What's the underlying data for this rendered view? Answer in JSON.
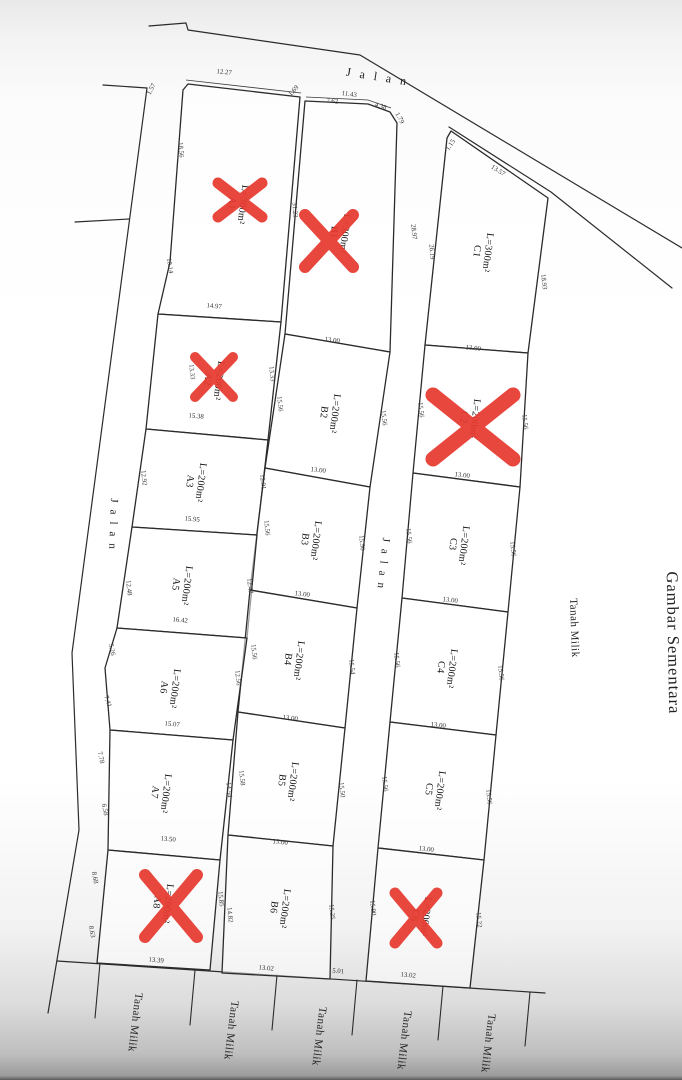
{
  "drawing": {
    "title_note": "Gambar Sementara",
    "road_word": "Jalan",
    "owned_land_word": "Tanah Milik",
    "line_color": "#2b2b2b",
    "cross_color": "#e6392e",
    "dim_color": "#333333"
  },
  "road_labels": [
    {
      "name": "road-label-jalan-top",
      "text": "Jalan",
      "x": 380,
      "y": 81,
      "rot": 9,
      "ls": 9,
      "fs": 12
    },
    {
      "name": "road-label-jalan-west",
      "text": "Jalan",
      "x": 110,
      "y": 527,
      "rot": 92,
      "ls": 7,
      "fs": 11
    },
    {
      "name": "road-label-jalan-middle",
      "text": "Jalan",
      "x": 380,
      "y": 566,
      "rot": 96,
      "ls": 7,
      "fs": 11
    },
    {
      "name": "land-label-tanah-milik-east",
      "text": "Tanah Milik",
      "x": 571,
      "y": 628,
      "rot": 88,
      "ls": 0.5,
      "fs": 11
    },
    {
      "name": "drawing-title-gambar-sementara",
      "text": "Gambar Sementara",
      "x": 668,
      "y": 643,
      "rot": 89,
      "ls": 1,
      "fs": 16.5
    },
    {
      "name": "land-label-tanah-milik-south-1",
      "text": "Tanah Milik",
      "x": 132,
      "y": 1022,
      "rot": 97,
      "ls": 0.5,
      "fs": 11
    },
    {
      "name": "land-label-tanah-milik-south-2",
      "text": "Tanah Milik",
      "x": 228,
      "y": 1030,
      "rot": 97,
      "ls": 0.5,
      "fs": 11
    },
    {
      "name": "land-label-tanah-milik-south-3",
      "text": "Tanah Milik",
      "x": 316,
      "y": 1036,
      "rot": 97,
      "ls": 0.5,
      "fs": 11
    },
    {
      "name": "land-label-tanah-milik-south-4",
      "text": "Tanah Milik",
      "x": 401,
      "y": 1040,
      "rot": 97,
      "ls": 0.5,
      "fs": 11
    },
    {
      "name": "land-label-tanah-milik-south-5",
      "text": "Tanah Milik",
      "x": 485,
      "y": 1043,
      "rot": 97,
      "ls": 0.5,
      "fs": 11
    }
  ],
  "plots": [
    {
      "code": "A1",
      "area": "L=300m²",
      "cx": 238,
      "cy": 204,
      "rot": 97,
      "poly": "188,84 300,97 281,322 158,314 170,262 183,90",
      "crossed": true,
      "cross": {
        "cx": 240,
        "cy": 200,
        "dx": 22,
        "dy": 17,
        "w": 11
      }
    },
    {
      "code": "B1",
      "area": "L=300m²",
      "cx": 340,
      "cy": 233,
      "rot": 97,
      "poly": "305,101 368,104 390,112 397,123 390,352 285,334",
      "crossed": true,
      "cross": {
        "cx": 329,
        "cy": 241,
        "dx": 24,
        "dy": 26,
        "w": 12
      }
    },
    {
      "code": "C1",
      "area": "L=300m²",
      "cx": 483,
      "cy": 252,
      "rot": 97,
      "poly": "447,138 451,131 548,198 528,353 425,345",
      "crossed": false
    },
    {
      "code": "A2",
      "area": "L=200m²",
      "cx": 214,
      "cy": 380,
      "rot": 97,
      "poly": "158,314 281,322 268,440 146,429",
      "crossed": true,
      "cross": {
        "cx": 214,
        "cy": 377,
        "dx": 19,
        "dy": 20,
        "w": 10
      }
    },
    {
      "code": "B2",
      "area": "L=200m²",
      "cx": 330,
      "cy": 413,
      "rot": 97,
      "poly": "285,334 390,352 370,487 265,468",
      "crossed": false
    },
    {
      "code": "C2",
      "area": "L=200m²",
      "cx": 470,
      "cy": 418,
      "rot": 97,
      "poly": "425,345 528,353 520,487 413,473",
      "crossed": true,
      "cross": {
        "cx": 473,
        "cy": 427,
        "dx": 40,
        "dy": 32,
        "w": 15
      }
    },
    {
      "code": "A3",
      "area": "L=200m²",
      "cx": 196,
      "cy": 482,
      "rot": 97,
      "poly": "146,429 268,440 257,535 132,527",
      "crossed": false
    },
    {
      "code": "B3",
      "area": "L=200m²",
      "cx": 311,
      "cy": 540,
      "rot": 97,
      "poly": "265,468 370,487 357,608 250,590",
      "crossed": false
    },
    {
      "code": "C3",
      "area": "L=200m²",
      "cx": 459,
      "cy": 545,
      "rot": 97,
      "poly": "413,473 520,487 508,612 402,598",
      "crossed": false
    },
    {
      "code": "A5",
      "area": "L=200m²",
      "cx": 182,
      "cy": 585,
      "rot": 97,
      "poly": "132,527 257,535 247,638 117,628",
      "crossed": false
    },
    {
      "code": "B4",
      "area": "L=200m²",
      "cx": 294,
      "cy": 660,
      "rot": 97,
      "poly": "250,590 357,608 345,728 238,712",
      "crossed": false
    },
    {
      "code": "C4",
      "area": "L=200m²",
      "cx": 447,
      "cy": 668,
      "rot": 97,
      "poly": "402,598 508,612 496,735 390,722",
      "crossed": false
    },
    {
      "code": "A6",
      "area": "L=200m²",
      "cx": 170,
      "cy": 688,
      "rot": 97,
      "poly": "117,628 247,638 233,740 110,730 105,668",
      "crossed": false
    },
    {
      "code": "A7",
      "area": "L=200m²",
      "cx": 161,
      "cy": 793,
      "rot": 97,
      "poly": "110,730 233,740 220,860 108,850",
      "crossed": false
    },
    {
      "code": "B5",
      "area": "L=200m²",
      "cx": 288,
      "cy": 781,
      "rot": 97,
      "poly": "238,712 345,728 333,846 228,835",
      "crossed": false
    },
    {
      "code": "C5",
      "area": "L=200m²",
      "cx": 435,
      "cy": 790,
      "rot": 97,
      "poly": "390,722 496,735 484,860 378,848",
      "crossed": false
    },
    {
      "code": "A8",
      "area": "L=200m²",
      "cx": 163,
      "cy": 903,
      "rot": 97,
      "poly": "108,850 220,860 210,970 97,963",
      "crossed": true,
      "cross": {
        "cx": 171,
        "cy": 906,
        "dx": 26,
        "dy": 31,
        "w": 12
      }
    },
    {
      "code": "B6",
      "area": "L=200m²",
      "cx": 280,
      "cy": 908,
      "rot": 97,
      "poly": "228,835 333,846 330,979 222,973",
      "crossed": false
    },
    {
      "code": "C6",
      "area": "L=200m²",
      "cx": 421,
      "cy": 916,
      "rot": 97,
      "poly": "378,848 484,860 470,988 366,981",
      "crossed": true,
      "cross": {
        "cx": 416,
        "cy": 918,
        "dx": 21,
        "dy": 25,
        "w": 11
      }
    }
  ],
  "dim_labels": [
    {
      "v": "1.57",
      "x": 153,
      "y": 90,
      "r": -62
    },
    {
      "v": "12.27",
      "x": 224,
      "y": 74,
      "r": 5
    },
    {
      "v": "18.56",
      "x": 179,
      "y": 150,
      "r": 85
    },
    {
      "v": "10.14",
      "x": 168,
      "y": 266,
      "r": 82
    },
    {
      "v": "14.97",
      "x": 214,
      "y": 308,
      "r": 5
    },
    {
      "v": "31.23",
      "x": 293,
      "y": 210,
      "r": 86
    },
    {
      "v": "1.69",
      "x": 295,
      "y": 92,
      "r": -48
    },
    {
      "v": "7.62",
      "x": 332,
      "y": 103,
      "r": 6
    },
    {
      "v": "11.43",
      "x": 349,
      "y": 96,
      "r": 8
    },
    {
      "v": "4.38",
      "x": 380,
      "y": 108,
      "r": 18
    },
    {
      "v": "1.79",
      "x": 398,
      "y": 119,
      "r": 60
    },
    {
      "v": "28.97",
      "x": 412,
      "y": 232,
      "r": 84
    },
    {
      "v": "13.00",
      "x": 332,
      "y": 342,
      "r": 7
    },
    {
      "v": "1.15",
      "x": 452,
      "y": 146,
      "r": -55
    },
    {
      "v": "13.57",
      "x": 497,
      "y": 172,
      "r": 33
    },
    {
      "v": "26.19",
      "x": 430,
      "y": 252,
      "r": 85
    },
    {
      "v": "18.93",
      "x": 542,
      "y": 282,
      "r": 83
    },
    {
      "v": "13.00",
      "x": 473,
      "y": 350,
      "r": 7
    },
    {
      "v": "13.33",
      "x": 190,
      "y": 372,
      "r": 84
    },
    {
      "v": "13.33",
      "x": 270,
      "y": 374,
      "r": 84
    },
    {
      "v": "15.38",
      "x": 196,
      "y": 418,
      "r": 5
    },
    {
      "v": "12.92",
      "x": 142,
      "y": 478,
      "r": 84
    },
    {
      "v": "12.91",
      "x": 261,
      "y": 482,
      "r": 84
    },
    {
      "v": "15.95",
      "x": 192,
      "y": 521,
      "r": 5
    },
    {
      "v": "12.48",
      "x": 127,
      "y": 588,
      "r": 84
    },
    {
      "v": "12.47",
      "x": 248,
      "y": 586,
      "r": 84
    },
    {
      "v": "16.42",
      "x": 180,
      "y": 622,
      "r": 5
    },
    {
      "v": "5.26",
      "x": 110,
      "y": 650,
      "r": 78
    },
    {
      "v": "7.41",
      "x": 106,
      "y": 702,
      "r": 72
    },
    {
      "v": "12.56",
      "x": 236,
      "y": 678,
      "r": 84
    },
    {
      "v": "15.07",
      "x": 172,
      "y": 726,
      "r": 5
    },
    {
      "v": "7.78",
      "x": 99,
      "y": 758,
      "r": 78
    },
    {
      "v": "6.58",
      "x": 103,
      "y": 810,
      "r": 78
    },
    {
      "v": "14.54",
      "x": 227,
      "y": 790,
      "r": 84
    },
    {
      "v": "13.50",
      "x": 168,
      "y": 841,
      "r": 5
    },
    {
      "v": "8.68",
      "x": 93,
      "y": 878,
      "r": 80
    },
    {
      "v": "8.63",
      "x": 90,
      "y": 932,
      "r": 80
    },
    {
      "v": "13.39",
      "x": 156,
      "y": 962,
      "r": 5
    },
    {
      "v": "15.85",
      "x": 219,
      "y": 899,
      "r": 84
    },
    {
      "v": "14.82",
      "x": 228,
      "y": 915,
      "r": 84
    },
    {
      "v": "15.56",
      "x": 278,
      "y": 404,
      "r": 84
    },
    {
      "v": "15.56",
      "x": 382,
      "y": 418,
      "r": 84
    },
    {
      "v": "13.00",
      "x": 318,
      "y": 472,
      "r": 7
    },
    {
      "v": "15.56",
      "x": 265,
      "y": 528,
      "r": 84
    },
    {
      "v": "15.56",
      "x": 360,
      "y": 543,
      "r": 84
    },
    {
      "v": "13.00",
      "x": 302,
      "y": 596,
      "r": 7
    },
    {
      "v": "15.56",
      "x": 252,
      "y": 652,
      "r": 84
    },
    {
      "v": "15.54",
      "x": 350,
      "y": 667,
      "r": 84
    },
    {
      "v": "13.00",
      "x": 290,
      "y": 720,
      "r": 7
    },
    {
      "v": "15.58",
      "x": 240,
      "y": 778,
      "r": 84
    },
    {
      "v": "15.50",
      "x": 340,
      "y": 790,
      "r": 84
    },
    {
      "v": "13.00",
      "x": 280,
      "y": 844,
      "r": 7
    },
    {
      "v": "15.25",
      "x": 330,
      "y": 912,
      "r": 84
    },
    {
      "v": "13.02",
      "x": 266,
      "y": 970,
      "r": 5
    },
    {
      "v": "5.01",
      "x": 338,
      "y": 973,
      "r": 5
    },
    {
      "v": "15.56",
      "x": 419,
      "y": 410,
      "r": 84
    },
    {
      "v": "15.56",
      "x": 523,
      "y": 422,
      "r": 84
    },
    {
      "v": "13.00",
      "x": 462,
      "y": 477,
      "r": 7
    },
    {
      "v": "15.56",
      "x": 407,
      "y": 536,
      "r": 84
    },
    {
      "v": "15.56",
      "x": 511,
      "y": 549,
      "r": 84
    },
    {
      "v": "13.00",
      "x": 450,
      "y": 602,
      "r": 7
    },
    {
      "v": "15.56",
      "x": 395,
      "y": 660,
      "r": 84
    },
    {
      "v": "15.56",
      "x": 499,
      "y": 673,
      "r": 84
    },
    {
      "v": "13.00",
      "x": 438,
      "y": 727,
      "r": 7
    },
    {
      "v": "15.56",
      "x": 383,
      "y": 784,
      "r": 84
    },
    {
      "v": "15.56",
      "x": 487,
      "y": 797,
      "r": 84
    },
    {
      "v": "13.00",
      "x": 426,
      "y": 851,
      "r": 7
    },
    {
      "v": "15.90",
      "x": 371,
      "y": 908,
      "r": 84
    },
    {
      "v": "15.22",
      "x": 477,
      "y": 920,
      "r": 84
    },
    {
      "v": "13.02",
      "x": 408,
      "y": 977,
      "r": 5
    }
  ]
}
